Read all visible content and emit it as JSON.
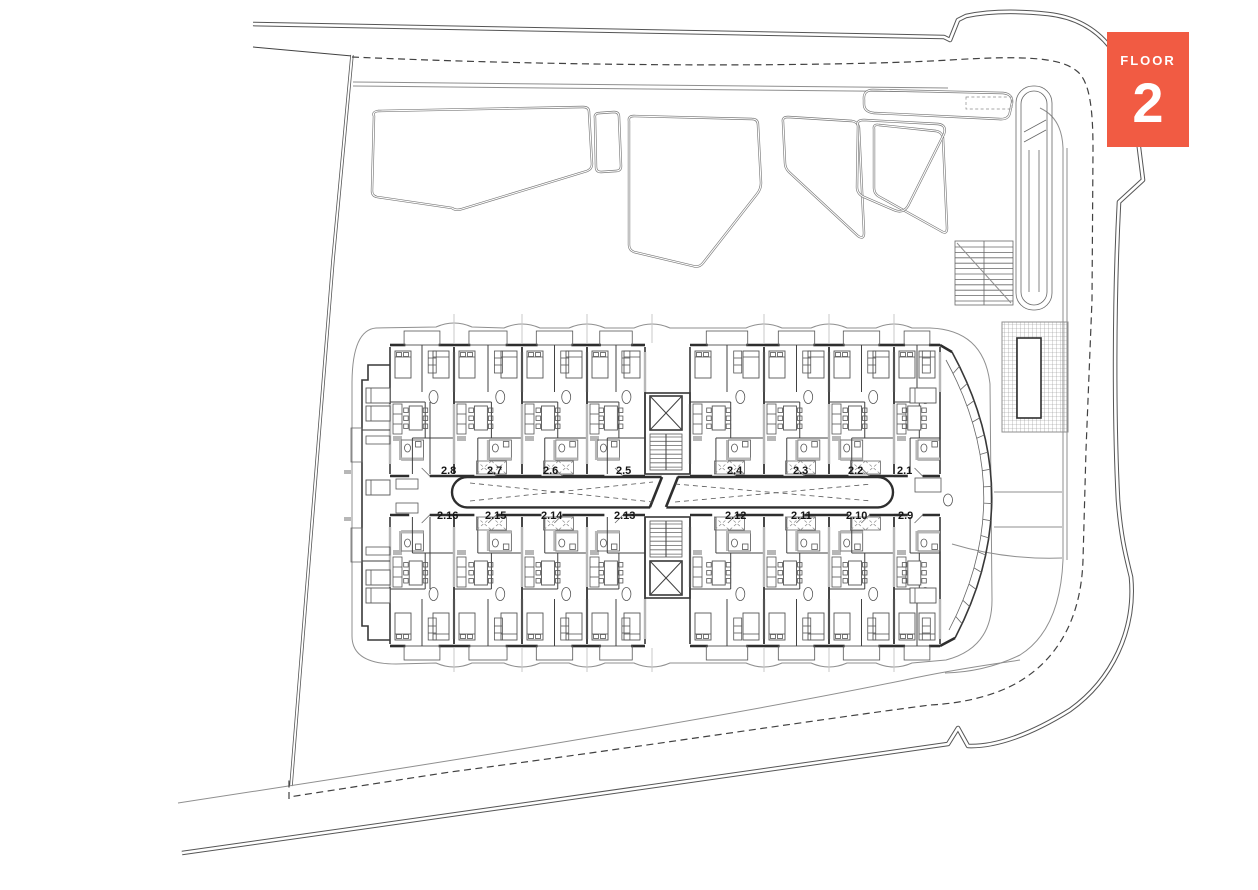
{
  "floor_badge": {
    "label": "FLOOR",
    "number": "2",
    "bg_color": "#F15B43",
    "text_color": "#FFFFFF"
  },
  "building": {
    "top_row_units": [
      {
        "id": "2.8"
      },
      {
        "id": "2.7"
      },
      {
        "id": "2.6"
      },
      {
        "id": "2.5"
      },
      {
        "id": "2.4"
      },
      {
        "id": "2.3"
      },
      {
        "id": "2.2"
      },
      {
        "id": "2.1"
      }
    ],
    "bottom_row_units": [
      {
        "id": "2.16"
      },
      {
        "id": "2.15"
      },
      {
        "id": "2.14"
      },
      {
        "id": "2.13"
      },
      {
        "id": "2.12"
      },
      {
        "id": "2.11"
      },
      {
        "id": "2.10"
      },
      {
        "id": "2.9"
      }
    ]
  },
  "drawing_colors": {
    "wall": "#383838",
    "light_line": "#8f8f8f",
    "grid_line": "#c9c9c9",
    "road": "#555555",
    "boundary_dash": "#414141",
    "poche_fill": "#b7b7b7",
    "label_text": "#161616",
    "background": "#ffffff"
  }
}
